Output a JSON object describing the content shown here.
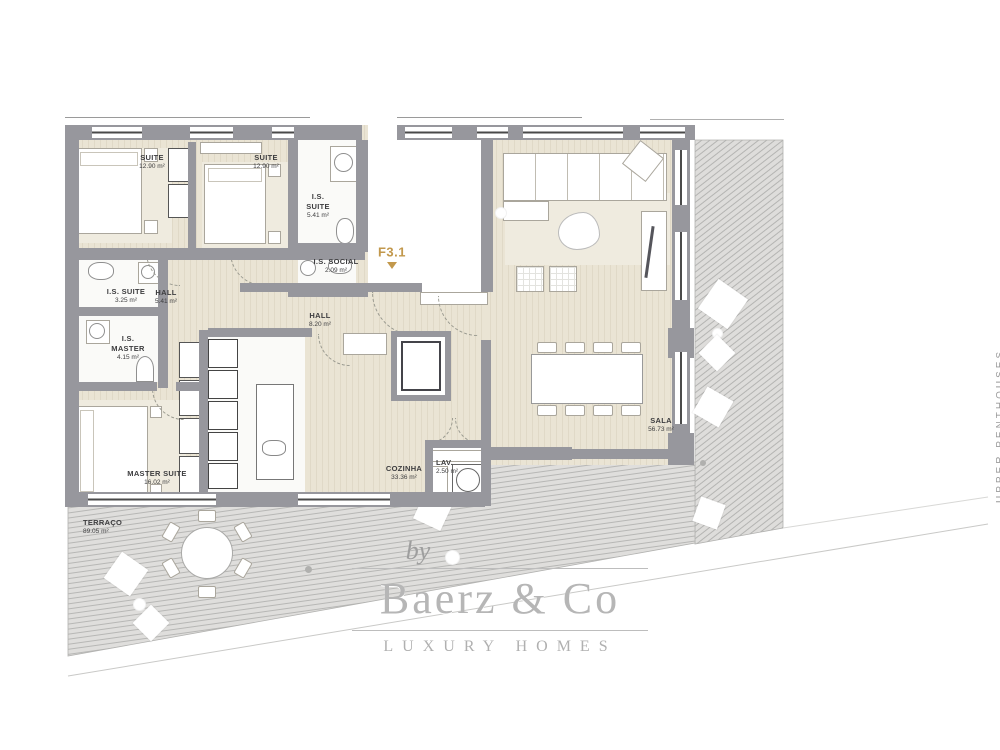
{
  "unit": {
    "label": "F3.1"
  },
  "rooms": [
    {
      "name": "SUITE",
      "area": "12.90 m²"
    },
    {
      "name": "SUITE",
      "area": "12.90 m²"
    },
    {
      "name": "I.S. SUITE",
      "area": "5.41 m²"
    },
    {
      "name": "I.S. SOCIAL",
      "area": "2.09 m²"
    },
    {
      "name": "I.S. SUITE",
      "area": "3.25 m²"
    },
    {
      "name": "HALL",
      "area": "5.41 m²"
    },
    {
      "name": "I.S. MASTER",
      "area": "4.15 m²"
    },
    {
      "name": "MASTER SUITE",
      "area": "16.02 m²"
    },
    {
      "name": "HALL",
      "area": "8.20 m²"
    },
    {
      "name": "COZINHA",
      "area": "33.36 m²"
    },
    {
      "name": "LAV.",
      "area": "2.50 m²"
    },
    {
      "name": "SALA",
      "area": "56.73 m²"
    },
    {
      "name": "TERRAÇO",
      "area": "89.05 m²"
    }
  ],
  "logo": {
    "by": "by",
    "brand": "Baerz & Co",
    "tagline": "LUXURY HOMES"
  },
  "side_text": "UPPER PENTHOUSES",
  "colors": {
    "wall_gray": "#97979d",
    "accent_gold": "#c2984c",
    "wood_floor": "#e6e0cf",
    "terrace_gray": "#dedddb",
    "logo_gray": "#b6b6b6",
    "label_text": "#3d3d3f"
  }
}
